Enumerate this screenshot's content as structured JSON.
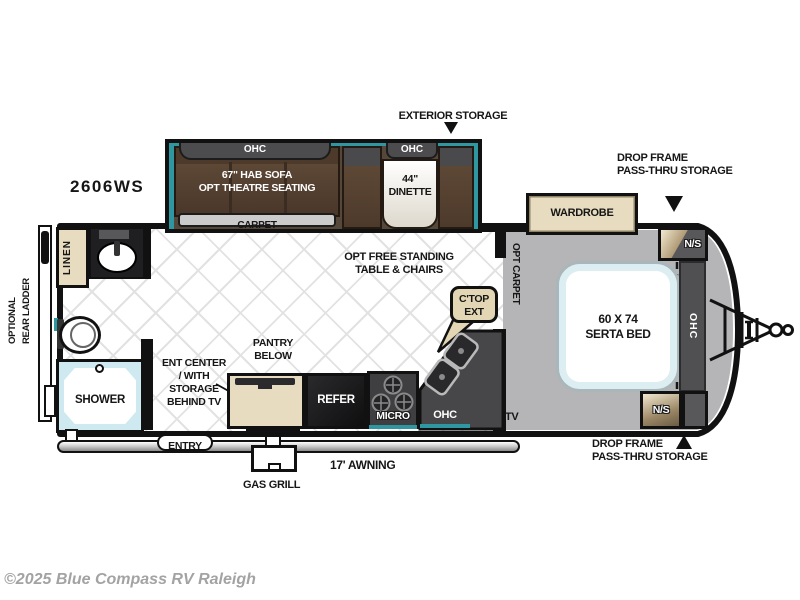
{
  "model_number": "2606WS",
  "watermark": "©2025 Blue Compass RV Raleigh",
  "colors": {
    "accent_teal": "#2f97a2",
    "cabinet_tan": "#e8dcc0",
    "sofa_brown": "#5d4836",
    "ohc_gray": "#4a4a4c",
    "bedroom_floor_gray": "#b5b5b7",
    "carpet_gray": "#cbcbcb"
  },
  "annotations": {
    "exterior_storage": "EXTERIOR STORAGE",
    "drop_frame_storage_top": [
      "DROP FRAME",
      "PASS-THRU STORAGE"
    ],
    "drop_frame_storage_bottom": [
      "DROP FRAME",
      "PASS-THRU STORAGE"
    ],
    "optional_rear_ladder": [
      "OPTIONAL",
      "REAR LADDER"
    ],
    "opt_free_standing": [
      "OPT FREE STANDING",
      "TABLE & CHAIRS"
    ],
    "awning": "17' AWNING",
    "gas_grill": "GAS GRILL",
    "entry": "ENTRY"
  },
  "living_area": {
    "sofa_ohc": "OHC",
    "sofa": [
      "67\" HAB SOFA",
      "OPT THEATRE SEATING"
    ],
    "carpet": "CARPET",
    "dinette_ohc": "OHC",
    "dinette": [
      "44\"",
      "DINETTE"
    ]
  },
  "kitchen": {
    "ent_center": [
      "ENT CENTER",
      "/ WITH",
      "STORAGE",
      "BEHIND TV"
    ],
    "pantry": [
      "PANTRY",
      "BELOW"
    ],
    "refer": "REFER",
    "micro": "MICRO",
    "ohc": "OHC",
    "ctop_ext": [
      "C'TOP",
      "EXT"
    ],
    "tv": "TV"
  },
  "bathroom": {
    "linen": "LINEN",
    "shower": "SHOWER"
  },
  "bedroom": {
    "wardrobe": "WARDROBE",
    "bed": [
      "60 X 74",
      "SERTA BED"
    ],
    "night_stand_top": "N/S",
    "night_stand_bottom": "N/S",
    "ohc": "OHC",
    "opt_carpet": "OPT CARPET"
  }
}
